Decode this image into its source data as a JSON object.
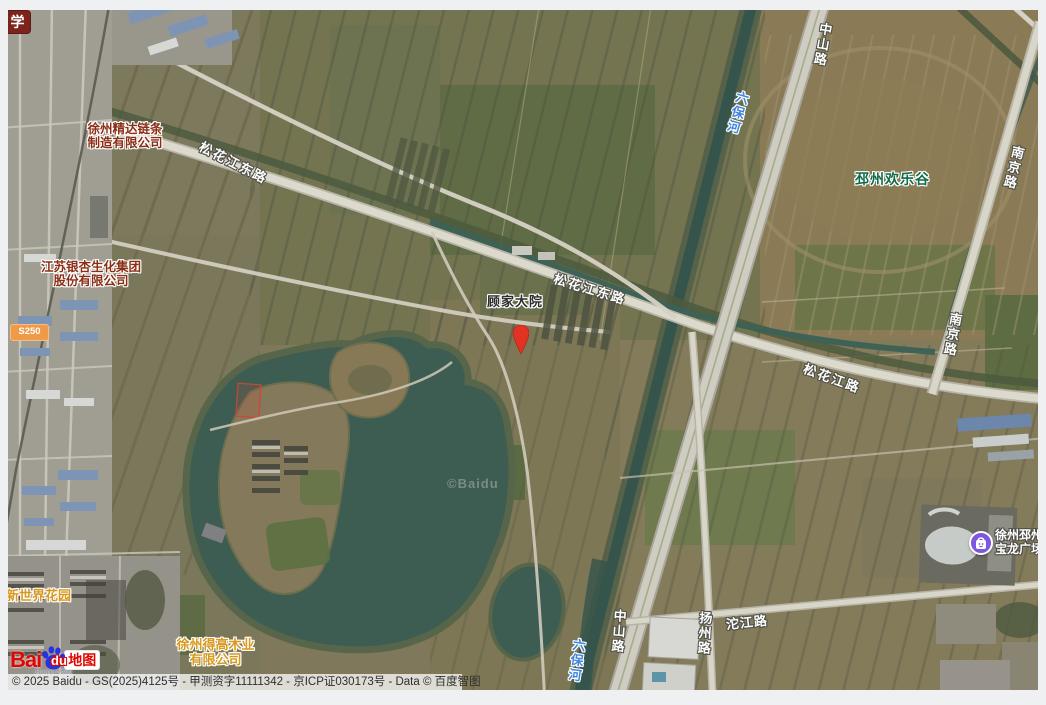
{
  "pois": {
    "jingda": "徐州精达链条\n制造有限公司",
    "yinxing": "江苏银杏生化集团\n股份有限公司",
    "gujia": "顾家大院",
    "huanlegu": "邳州欢乐谷",
    "xinshijie": "邳新世界花园",
    "degao": "徐州得高木业\n有限公司",
    "baolong": "徐州邳州\n宝龙广场",
    "edge_partial": "储运"
  },
  "roads": {
    "songhuajiang_dong_w": "松花江东路",
    "songhuajiang_dong_e": "松花江东路",
    "songhuajiang_e": "松花江路",
    "zhongshan_n": "中山路",
    "zhongshan_s": "中山路",
    "yangzhou": "扬州路",
    "tuojiang": "沱江路",
    "nanjing_n": "南京路",
    "nanjing_s": "南京路"
  },
  "water": {
    "liubaohe_n": "六保河",
    "liubaohe_s": "六保河"
  },
  "badges": {
    "school": "学",
    "route": "S250"
  },
  "pin": {
    "color": "#e23222"
  },
  "watermark": "©Baidu",
  "logo": {
    "bai": "Bai",
    "du": "du",
    "map": "地图",
    "script": "Baidu地图"
  },
  "attribution": {
    "text": "© 2025 Baidu - GS(2025)4125号 - 甲测资字11111342 - 京ICP证030173号 - Data © 百度智图"
  },
  "colors": {
    "pin_red": "#e23222",
    "poi_company_red": "#8b2e16",
    "poi_orange": "#d8991e",
    "poi_green": "#0f6b49",
    "road_label": "#fdfdfb",
    "water_label": "#4285dd",
    "route_badge_bg": "#ee9a47",
    "school_badge_bg": "#7c241c",
    "baolong_icon_purple": "#7d57e0",
    "baidu_red": "#e10601",
    "baidu_blue": "#2932e1",
    "lake_water": "#3d5c52"
  }
}
